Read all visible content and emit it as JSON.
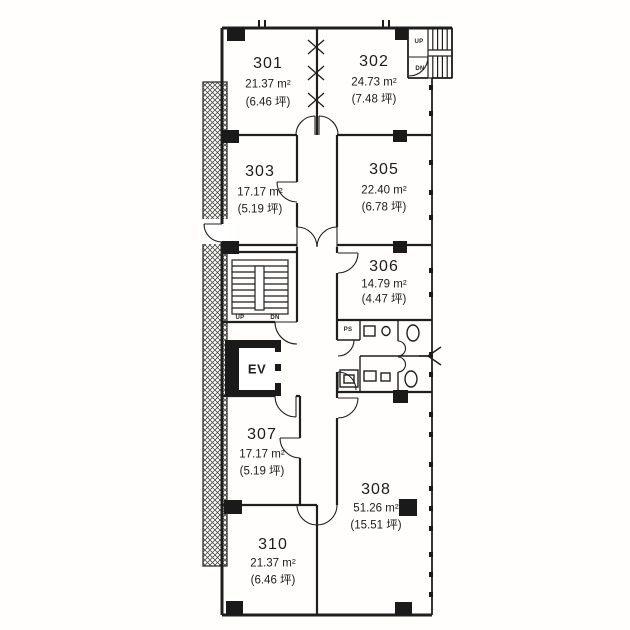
{
  "plan": {
    "type": "building-floor-plan",
    "rooms": [
      {
        "number": "301",
        "area": "21.37 m²",
        "tsubo": "(6.46 坪)"
      },
      {
        "number": "302",
        "area": "24.73 m²",
        "tsubo": "(7.48 坪)"
      },
      {
        "number": "303",
        "area": "17.17 m²",
        "tsubo": "(5.19 坪)"
      },
      {
        "number": "305",
        "area": "22.40 m²",
        "tsubo": "(6.78 坪)"
      },
      {
        "number": "306",
        "area": "14.79 m²",
        "tsubo": "(4.47 坪)"
      },
      {
        "number": "307",
        "area": "17.17 m²",
        "tsubo": "(5.19 坪)"
      },
      {
        "number": "308",
        "area": "51.26 m²",
        "tsubo": "(15.51 坪)"
      },
      {
        "number": "310",
        "area": "21.37 m²",
        "tsubo": "(6.46 坪)"
      }
    ],
    "labels": {
      "elevator": "EV",
      "pipe_shaft": "PS",
      "main_stair_up": "UP",
      "main_stair_down": "DN",
      "upper_stair_up": "UP",
      "upper_stair_down": "DN"
    },
    "colors": {
      "ink": "#1f1f1f",
      "background": "#fffefd"
    }
  }
}
